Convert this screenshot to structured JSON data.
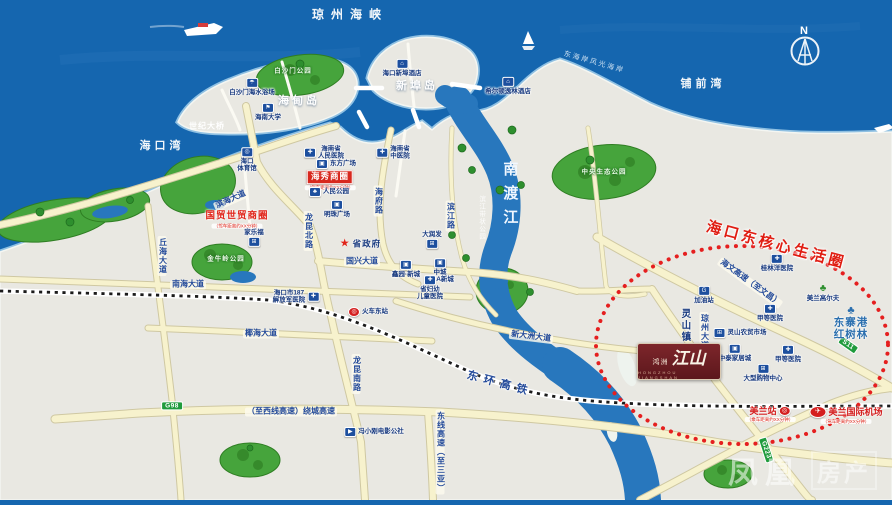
{
  "project": {
    "brand": "鸿洲",
    "name": "江山",
    "subtitle": "HONGZHOU JIANGSHAN"
  },
  "watermark": {
    "part1": "凤凰",
    "part2": "房产"
  },
  "compass": {
    "north": "N"
  },
  "colors": {
    "sea": "#1566af",
    "land": "#e9e8e2",
    "park_green": "#46a43c",
    "river": "#2877bd",
    "road_fill": "#f7f2cd",
    "highlight_red": "#e0201f",
    "badge_green": "#1f9b3c",
    "brand_maroon": "#6e2026",
    "poi_blue": "#1d4f9e"
  },
  "icon_glyphs": {
    "hospital-icon": "✚",
    "cart-icon": "⊞",
    "hotel-icon": "⌂",
    "university-icon": "⚑",
    "stadium-icon": "◎",
    "plaza-icon": "▣",
    "park-icon": "♣",
    "star-icon": "★",
    "train-icon": "◎",
    "plane-icon": "✈",
    "gas-icon": "G",
    "tree-icon": "♣",
    "mangrove-icon": "♣",
    "beach-umbrella-icon": "☂",
    "movie-icon": "▶"
  },
  "labels": [
    {
      "name": "strait-label",
      "cls": "sea",
      "text": "琼州海峡",
      "x": 350,
      "y": 15
    },
    {
      "name": "haikou-bay-label",
      "cls": "sea-sm",
      "text": "海口湾",
      "x": 162,
      "y": 146
    },
    {
      "name": "puqian-bay-label",
      "cls": "sea-sm",
      "text": "铺前湾",
      "x": 703,
      "y": 84
    },
    {
      "name": "east-coast-strip-label",
      "cls": "sea-xs",
      "text": "东海岸风光海岸",
      "x": 594,
      "y": 63,
      "rotate": 16
    },
    {
      "name": "haidian-island-label",
      "cls": "island",
      "text": "海甸岛",
      "x": 299,
      "y": 101
    },
    {
      "name": "xinbu-island-label",
      "cls": "island",
      "text": "新埠岛",
      "x": 417,
      "y": 86
    },
    {
      "name": "nandu-river-label",
      "cls": "river",
      "text": "南渡江",
      "x": 509,
      "y": 197
    },
    {
      "name": "riverside-park-label",
      "cls": "riverside",
      "text": "滨江带状公园",
      "x": 481,
      "y": 218
    },
    {
      "name": "century-bridge-label",
      "cls": "bridgelbl",
      "text": "世纪大桥",
      "x": 207,
      "y": 127
    },
    {
      "name": "binhai-avenue-label",
      "cls": "roadp",
      "text": "滨海大道",
      "x": 231,
      "y": 200,
      "rotate": -24
    },
    {
      "name": "qiuhai-avenue-label",
      "cls": "roadp vert",
      "text": "丘海大道",
      "x": 162,
      "y": 256
    },
    {
      "name": "longkun-north-road-label",
      "cls": "roadp vert",
      "text": "龙昆北路",
      "x": 308,
      "y": 231
    },
    {
      "name": "longkun-south-road-label",
      "cls": "roadp vert",
      "text": "龙昆南路",
      "x": 356,
      "y": 374
    },
    {
      "name": "haifu-road-label",
      "cls": "roadp vert",
      "text": "海府路",
      "x": 378,
      "y": 201
    },
    {
      "name": "binjiang-road-label",
      "cls": "roadp vert",
      "text": "滨江路",
      "x": 450,
      "y": 216
    },
    {
      "name": "nanhai-avenue-label",
      "cls": "roadp",
      "text": "南海大道",
      "x": 188,
      "y": 285
    },
    {
      "name": "yehai-avenue-label",
      "cls": "roadp",
      "text": "椰海大道",
      "x": 261,
      "y": 334
    },
    {
      "name": "guoxing-avenue-label",
      "cls": "roadp",
      "text": "国兴大道",
      "x": 362,
      "y": 262
    },
    {
      "name": "xindazhou-avenue-label",
      "cls": "roadp",
      "text": "新大洲大道",
      "x": 531,
      "y": 337,
      "rotate": 7
    },
    {
      "name": "donghuan-hsr-label",
      "cls": "raillbl",
      "text": "东环高铁",
      "x": 500,
      "y": 384,
      "rotate": 15
    },
    {
      "name": "raocheng-expressway-label",
      "cls": "roadp",
      "text": "（至西线高速）绕城高速",
      "x": 291,
      "y": 412
    },
    {
      "name": "dongxian-expressway-label",
      "cls": "roadp vert",
      "text": "东线高速（至三亚）",
      "x": 440,
      "y": 452
    },
    {
      "name": "haiwen-expressway-label",
      "cls": "roadp",
      "text": "海文高速（至文昌）",
      "x": 750,
      "y": 283,
      "rotate": 36
    },
    {
      "name": "qiongzhou-avenue-label",
      "cls": "roadp vert",
      "text": "琼州大道",
      "x": 704,
      "y": 332
    },
    {
      "name": "g98-badge",
      "cls": "badge",
      "text": "G98",
      "x": 172,
      "y": 406
    },
    {
      "name": "s11-badge",
      "cls": "badge",
      "text": "S11",
      "x": 848,
      "y": 345,
      "rotate": 35
    },
    {
      "name": "g223-badge",
      "cls": "badge",
      "text": "G223",
      "x": 766,
      "y": 450,
      "rotate": 72
    },
    {
      "name": "haixiu-business-district-label",
      "cls": "bizbox",
      "text": "海秀商圈",
      "sub": "（驾车距离约XX分钟）",
      "x": 330,
      "y": 180
    },
    {
      "name": "guomao-business-district-label",
      "cls": "biztext",
      "text": "国贸世贸商圈",
      "sub": "（驾车距离约XX分钟）",
      "x": 237,
      "y": 220
    },
    {
      "name": "east-core-living-circle-label",
      "cls": "core",
      "text": "海口东核心生活圈",
      "x": 776,
      "y": 246,
      "rotate": 15
    },
    {
      "name": "baishamen-park-label",
      "cls": "parklbl",
      "text": "白沙门公园",
      "x": 293,
      "y": 71
    },
    {
      "name": "baishamen-beach-label",
      "cls": "poi",
      "icon": "beach-umbrella-icon",
      "text": "白沙门海水浴场",
      "x": 252,
      "y": 87
    },
    {
      "name": "hainan-university-label",
      "cls": "poi",
      "icon": "university-icon",
      "text": "海南大学",
      "x": 268,
      "y": 112
    },
    {
      "name": "xinbu-hotel-label",
      "cls": "poi",
      "icon": "hotel-icon",
      "text": "海口新埠酒店",
      "x": 402,
      "y": 68
    },
    {
      "name": "hilton-hotel-label",
      "cls": "poi",
      "icon": "hotel-icon",
      "text": "希尔顿逸林酒店",
      "x": 508,
      "y": 86
    },
    {
      "name": "haikou-stadium-label",
      "cls": "poi",
      "icon": "stadium-icon",
      "lines": [
        "海口",
        "体育馆"
      ],
      "x": 247,
      "y": 160
    },
    {
      "name": "provincial-peoples-hospital-label",
      "cls": "poi",
      "icon": "hospital-icon",
      "layout": "icon-left",
      "lines": [
        "海南省",
        "人民医院"
      ],
      "x": 324,
      "y": 153
    },
    {
      "name": "provincial-tcm-hospital-label",
      "cls": "poi",
      "icon": "hospital-icon",
      "layout": "icon-left",
      "lines": [
        "海南省",
        "中医院"
      ],
      "x": 393,
      "y": 153
    },
    {
      "name": "dongfang-plaza-label",
      "cls": "poi",
      "icon": "plaza-icon",
      "layout": "icon-left",
      "text": "东方广场",
      "x": 336,
      "y": 164
    },
    {
      "name": "peoples-park-label",
      "cls": "poi",
      "icon": "park-icon",
      "layout": "icon-left",
      "text": "人民公园",
      "x": 329,
      "y": 192
    },
    {
      "name": "mingzhu-plaza-label",
      "cls": "poi",
      "icon": "plaza-icon",
      "text": "明珠广场",
      "x": 337,
      "y": 209
    },
    {
      "name": "provincial-government-label",
      "cls": "gov",
      "icon": "star-icon",
      "iconCls": "star",
      "layout": "icon-left",
      "text": "省政府",
      "x": 360,
      "y": 244
    },
    {
      "name": "rt-mart-label",
      "cls": "poi",
      "icon": "cart-icon",
      "layout": "icon-bottom",
      "text": "大润发",
      "x": 432,
      "y": 240
    },
    {
      "name": "carrefour-label",
      "cls": "poi",
      "icon": "cart-icon",
      "layout": "icon-bottom",
      "text": "家乐福",
      "x": 254,
      "y": 238
    },
    {
      "name": "jinniuling-park-label",
      "cls": "parklbl",
      "text": "金牛岭公园",
      "x": 226,
      "y": 259
    },
    {
      "name": "pla-187-hospital-label",
      "cls": "poi",
      "icon": "hospital-icon",
      "layout": "icon-right",
      "lines": [
        "海口市187",
        "解放军医院"
      ],
      "x": 296,
      "y": 297
    },
    {
      "name": "east-railway-station-label",
      "cls": "poi",
      "icon": "train-icon",
      "iconCls": "red",
      "layout": "icon-left",
      "text": "火车东站",
      "x": 368,
      "y": 312
    },
    {
      "name": "xinyuan-newtown-label",
      "cls": "poi",
      "icon": "plaza-icon",
      "text": "鑫园·新城",
      "x": 406,
      "y": 269
    },
    {
      "name": "ama-newtown-label",
      "cls": "poi",
      "icon": "plaza-icon",
      "lines": [
        "中城",
        "AMA新城"
      ],
      "x": 440,
      "y": 271
    },
    {
      "name": "children-hospital-label",
      "cls": "poi",
      "icon": "hospital-icon",
      "lines": [
        "省妇幼",
        "儿童医院"
      ],
      "x": 430,
      "y": 288
    },
    {
      "name": "movie-commune-label",
      "cls": "poi",
      "icon": "movie-icon",
      "layout": "icon-left",
      "text": "冯小刚电影公社",
      "x": 374,
      "y": 432
    },
    {
      "name": "central-eco-park-label",
      "cls": "parklbl",
      "text": "中央生态公园",
      "x": 604,
      "y": 172
    },
    {
      "name": "gas-station-label",
      "cls": "poi",
      "icon": "gas-icon",
      "text": "加油站",
      "x": 704,
      "y": 295
    },
    {
      "name": "lingshan-town-label",
      "cls": "town",
      "text": "灵山镇",
      "x": 684,
      "y": 326
    },
    {
      "name": "lingshan-market-label",
      "cls": "poi",
      "icon": "cart-icon",
      "layout": "icon-left",
      "text": "灵山农贸市场",
      "x": 740,
      "y": 333
    },
    {
      "name": "grade-a-hospital-1-label",
      "cls": "poi",
      "icon": "hospital-icon",
      "text": "甲等医院",
      "x": 770,
      "y": 313
    },
    {
      "name": "grade-a-hospital-2-label",
      "cls": "poi",
      "icon": "hospital-icon",
      "text": "甲等医院",
      "x": 788,
      "y": 354
    },
    {
      "name": "zhongtai-home-mall-label",
      "cls": "poi",
      "icon": "plaza-icon",
      "text": "中泰家居城",
      "x": 735,
      "y": 353
    },
    {
      "name": "shopping-center-label",
      "cls": "poi",
      "icon": "cart-icon",
      "text": "大型购物中心",
      "x": 763,
      "y": 373
    },
    {
      "name": "meilan-golf-label",
      "cls": "poi",
      "icon": "tree-icon",
      "iconCls": "plant",
      "text": "美兰高尔夫",
      "x": 823,
      "y": 293
    },
    {
      "name": "guilinyang-hospital-label",
      "cls": "poi",
      "icon": "hospital-icon",
      "text": "桂林洋医院",
      "x": 777,
      "y": 263
    },
    {
      "name": "dongzhaigang-mangrove-label",
      "cls": "mangrove",
      "icon": "mangrove-icon",
      "iconCls": "mang",
      "lines": [
        "东寨港",
        "红树林"
      ],
      "x": 851,
      "y": 323
    },
    {
      "name": "meilan-station-label",
      "cls": "station",
      "icon": "train-icon",
      "iconCls": "red",
      "layout": "icon-right",
      "text": "美兰站",
      "sub": "（乘车距离约XX分钟）",
      "x": 770,
      "y": 414
    },
    {
      "name": "meilan-airport-label",
      "cls": "station",
      "icon": "plane-icon",
      "iconCls": "redoval",
      "layout": "icon-left",
      "text": "美兰国际机场",
      "sub": "（驾车距离约XX分钟）",
      "x": 846,
      "y": 415
    }
  ]
}
